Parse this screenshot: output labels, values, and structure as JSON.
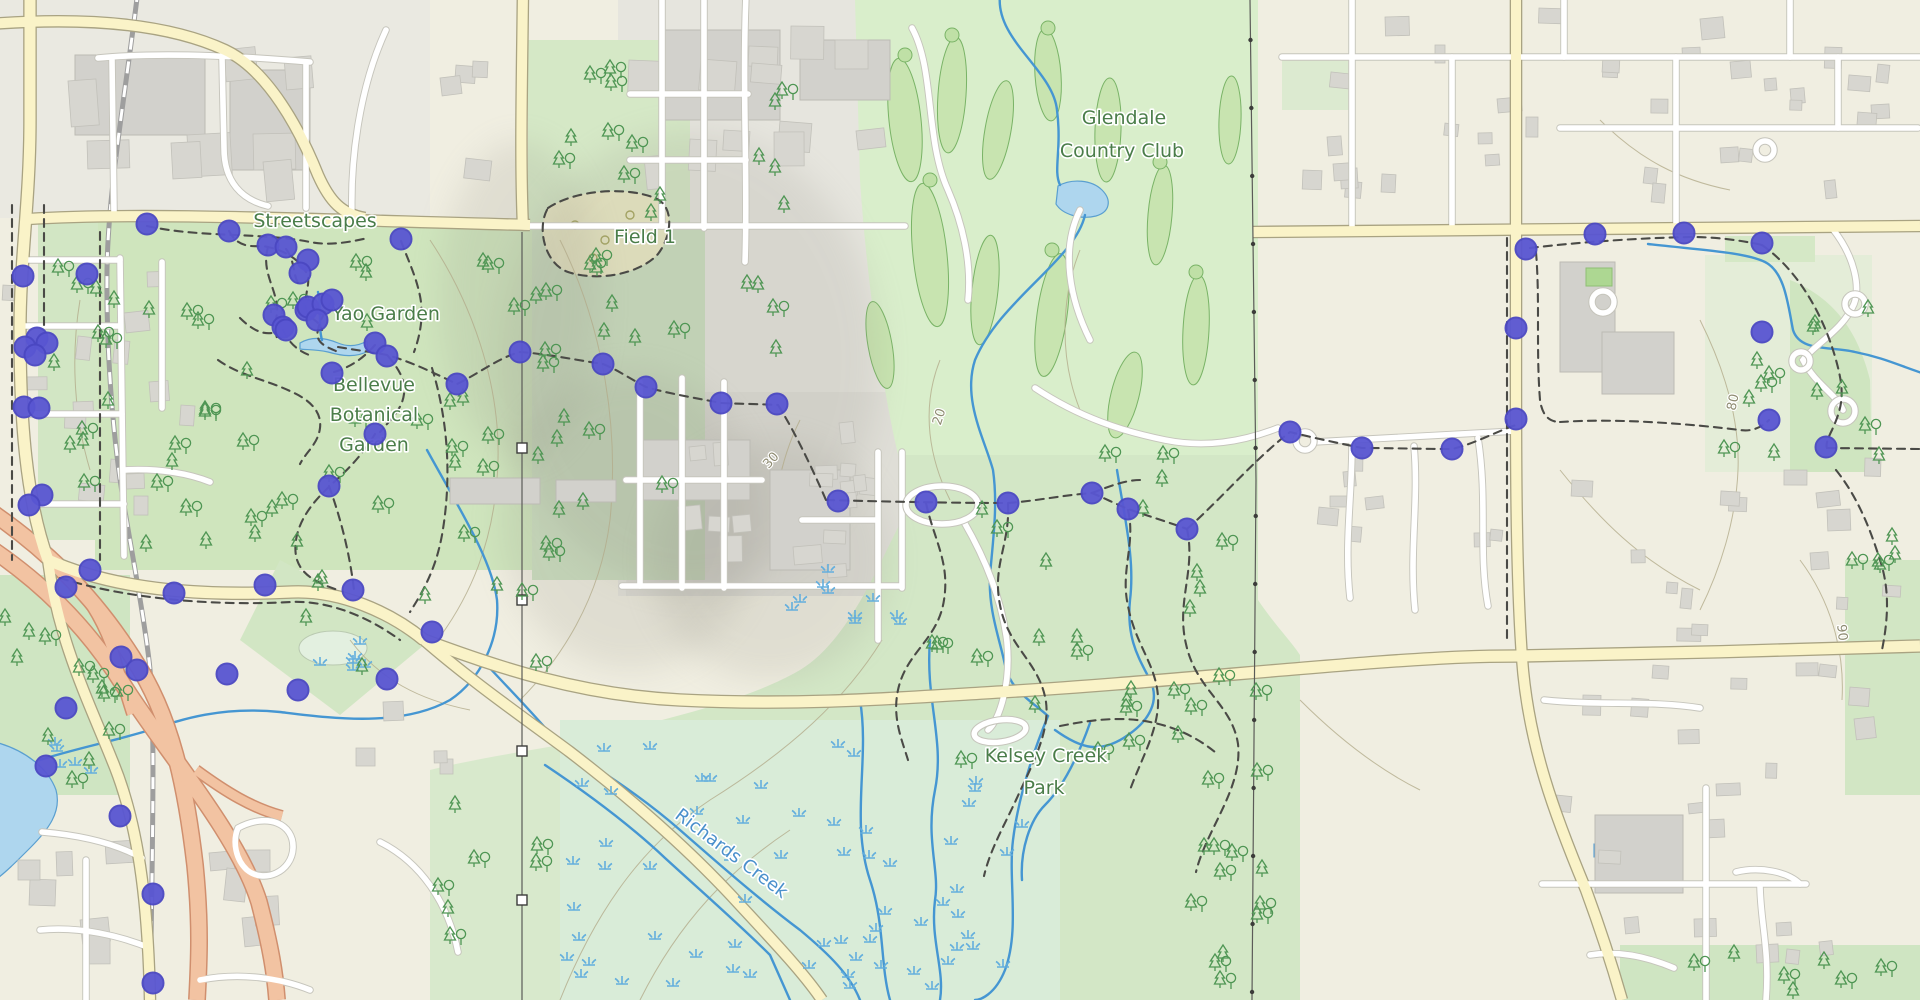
{
  "map": {
    "title": "Topographic trail map with route waypoints",
    "labels": [
      {
        "text": "Streetscapes",
        "x": 315,
        "y": 227,
        "kind": "park",
        "rotate": 0
      },
      {
        "text": "Yao Garden",
        "x": 386,
        "y": 320,
        "kind": "park",
        "rotate": 0
      },
      {
        "text": "Bellevue",
        "x": 374,
        "y": 391,
        "kind": "park",
        "rotate": 0
      },
      {
        "text": "Botanical",
        "x": 374,
        "y": 421,
        "kind": "park",
        "rotate": 0
      },
      {
        "text": "Garden",
        "x": 374,
        "y": 451,
        "kind": "park",
        "rotate": 0
      },
      {
        "text": "Field 1",
        "x": 645,
        "y": 243,
        "kind": "park",
        "rotate": 0
      },
      {
        "text": "Glendale",
        "x": 1124,
        "y": 124,
        "kind": "park",
        "rotate": 0
      },
      {
        "text": "Country Club",
        "x": 1122,
        "y": 157,
        "kind": "park",
        "rotate": 0
      },
      {
        "text": "Kelsey Creek",
        "x": 1046,
        "y": 762,
        "kind": "park",
        "rotate": 0
      },
      {
        "text": "Park",
        "x": 1044,
        "y": 794,
        "kind": "park",
        "rotate": 0
      },
      {
        "text": "Richards Creek",
        "x": 728,
        "y": 858,
        "kind": "water",
        "rotate": 37
      },
      {
        "text": "30",
        "x": 774,
        "y": 463,
        "kind": "contour",
        "rotate": -48
      },
      {
        "text": "20",
        "x": 943,
        "y": 418,
        "kind": "contour",
        "rotate": -72
      },
      {
        "text": "80",
        "x": 1737,
        "y": 403,
        "kind": "contour",
        "rotate": -78
      },
      {
        "text": "90",
        "x": 1838,
        "y": 633,
        "kind": "contour",
        "rotate": 84
      }
    ],
    "waypoints": {
      "fill": "#5956d2",
      "stroke": "#4a47c2",
      "radius": 10.5,
      "points": [
        [
          147,
          224
        ],
        [
          87,
          274
        ],
        [
          23,
          276
        ],
        [
          37,
          338
        ],
        [
          25,
          347
        ],
        [
          47,
          343
        ],
        [
          35,
          355
        ],
        [
          24,
          407
        ],
        [
          39,
          408
        ],
        [
          42,
          495
        ],
        [
          29,
          505
        ],
        [
          90,
          570
        ],
        [
          66,
          587
        ],
        [
          174,
          593
        ],
        [
          265,
          585
        ],
        [
          121,
          657
        ],
        [
          137,
          670
        ],
        [
          227,
          674
        ],
        [
          298,
          690
        ],
        [
          66,
          708
        ],
        [
          46,
          766
        ],
        [
          120,
          816
        ],
        [
          153,
          894
        ],
        [
          153,
          983
        ],
        [
          229,
          231
        ],
        [
          268,
          245
        ],
        [
          286,
          247
        ],
        [
          308,
          260
        ],
        [
          300,
          273
        ],
        [
          306,
          310
        ],
        [
          274,
          315
        ],
        [
          283,
          327
        ],
        [
          308,
          307
        ],
        [
          323,
          304
        ],
        [
          332,
          300
        ],
        [
          317,
          320
        ],
        [
          286,
          330
        ],
        [
          401,
          239
        ],
        [
          375,
          343
        ],
        [
          387,
          356
        ],
        [
          332,
          373
        ],
        [
          375,
          434
        ],
        [
          329,
          486
        ],
        [
          353,
          590
        ],
        [
          457,
          384
        ],
        [
          520,
          352
        ],
        [
          603,
          364
        ],
        [
          646,
          387
        ],
        [
          721,
          403
        ],
        [
          777,
          404
        ],
        [
          838,
          501
        ],
        [
          926,
          502
        ],
        [
          1008,
          503
        ],
        [
          1092,
          493
        ],
        [
          1128,
          509
        ],
        [
          1187,
          529
        ],
        [
          432,
          632
        ],
        [
          387,
          679
        ],
        [
          1290,
          432
        ],
        [
          1362,
          448
        ],
        [
          1452,
          449
        ],
        [
          1516,
          419
        ],
        [
          1526,
          249
        ],
        [
          1595,
          234
        ],
        [
          1684,
          233
        ],
        [
          1762,
          243
        ],
        [
          1516,
          328
        ],
        [
          1762,
          332
        ],
        [
          1769,
          420
        ],
        [
          1826,
          447
        ]
      ]
    },
    "colors": {
      "waypoint_fill": "#5956d2",
      "waypoint_stroke": "#4a47c2",
      "park_label": "#4a7d49",
      "water_label": "#4a90cc",
      "contour_label": "#8f8c72",
      "stream": "#4596d2",
      "water_fill": "#aed6ee",
      "road_major": "#faf3c8",
      "motorway": "#f2c3a2",
      "forest": "#cfe5bd",
      "golf": "#d9eecb"
    }
  }
}
